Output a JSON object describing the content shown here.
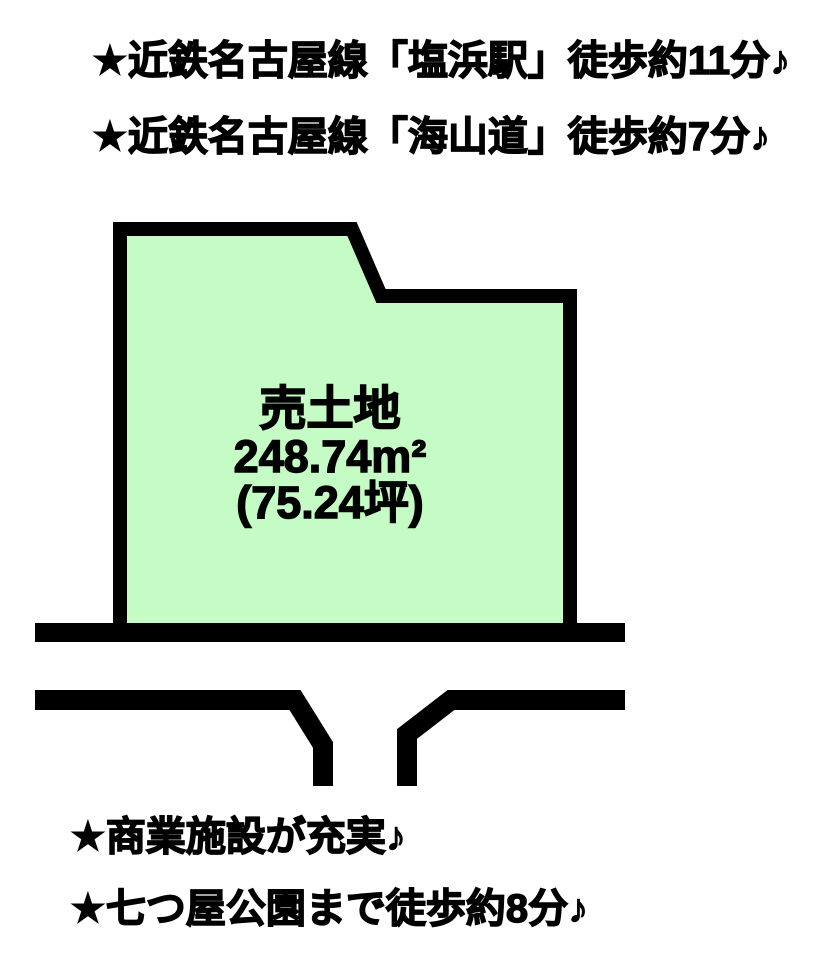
{
  "colors": {
    "plot_fill": "#c5fcc5",
    "line": "#000000",
    "background": "#ffffff",
    "text": "#000000"
  },
  "notes": {
    "top": [
      "★近鉄名古屋線「塩浜駅」徒歩約11分♪",
      "★近鉄名古屋線「海山道」徒歩約7分♪"
    ],
    "bottom": [
      "★商業施設が充実♪",
      "★七つ屋公園まで徒歩約8分♪"
    ]
  },
  "plot": {
    "title": "売土地",
    "area_m2": "248.74m²",
    "area_tsubo": "(75.24坪)"
  }
}
